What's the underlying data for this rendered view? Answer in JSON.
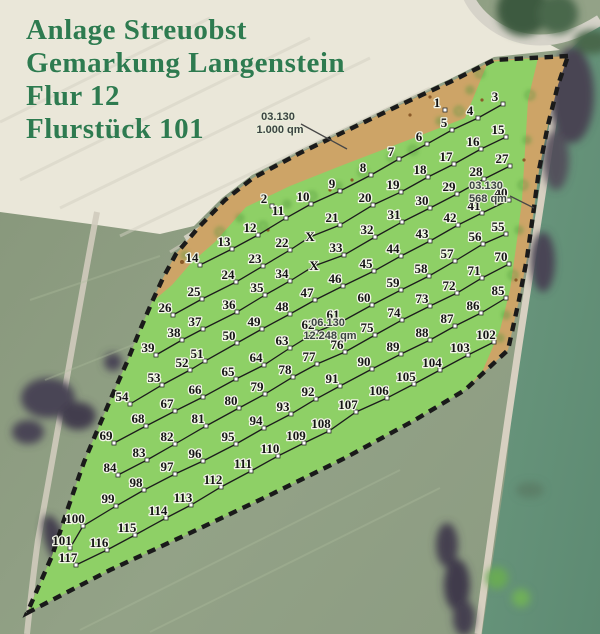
{
  "title": {
    "lines": [
      "Anlage Streuobst",
      "Gemarkung Langenstein",
      "Flur 12",
      "Flurstück 101"
    ]
  },
  "area_labels": [
    {
      "name": "north-strip-label",
      "code": "03.130",
      "area": "1.000 qm",
      "x": 278,
      "y": 120,
      "leader": [
        301,
        124,
        347,
        149
      ]
    },
    {
      "name": "east-strip-label",
      "code": "03.130",
      "area": "568 qm",
      "x": 486,
      "y": 189,
      "leader": [
        510,
        196,
        534,
        208
      ]
    },
    {
      "name": "main-parcel-label",
      "code": "06.130",
      "area": "12.248 qm",
      "x": 328,
      "y": 326,
      "leader": null
    }
  ],
  "planting": {
    "rows": [
      {
        "connected": false,
        "points": [
          [
            "1",
            445,
            110
          ],
          [
            "2",
            272,
            206
          ]
        ]
      },
      {
        "connected": true,
        "points": [
          [
            "3",
            503,
            104
          ],
          [
            "4",
            478,
            118
          ],
          [
            "5",
            452,
            130
          ],
          [
            "6",
            427,
            144
          ],
          [
            "7",
            399,
            159
          ],
          [
            "8",
            371,
            175
          ],
          [
            "9",
            340,
            191
          ],
          [
            "10",
            311,
            204
          ],
          [
            "11",
            286,
            218
          ],
          [
            "12",
            258,
            235
          ],
          [
            "13",
            232,
            249
          ],
          [
            "14",
            200,
            265
          ]
        ]
      },
      {
        "connected": true,
        "points": [
          [
            "15",
            506,
            137
          ],
          [
            "16",
            481,
            149
          ],
          [
            "17",
            454,
            164
          ],
          [
            "18",
            428,
            177
          ],
          [
            "19",
            401,
            192
          ],
          [
            "20",
            373,
            205
          ],
          [
            "21",
            340,
            225
          ],
          [
            "X",
            310,
            237,
            "x"
          ],
          [
            "22",
            290,
            250
          ],
          [
            "23",
            263,
            266
          ],
          [
            "24",
            236,
            282
          ],
          [
            "25",
            202,
            299
          ],
          [
            "26",
            173,
            315
          ]
        ]
      },
      {
        "connected": true,
        "points": [
          [
            "27",
            510,
            166
          ],
          [
            "28",
            484,
            179
          ],
          [
            "29",
            457,
            194
          ],
          [
            "30",
            430,
            208
          ],
          [
            "31",
            402,
            222
          ],
          [
            "32",
            375,
            237
          ],
          [
            "33",
            344,
            255
          ],
          [
            "X",
            314,
            266,
            "x"
          ],
          [
            "34",
            290,
            281
          ],
          [
            "35",
            265,
            295
          ],
          [
            "36",
            237,
            312
          ],
          [
            "37",
            203,
            329
          ],
          [
            "38",
            182,
            340
          ],
          [
            "39",
            156,
            355
          ]
        ]
      },
      {
        "connected": true,
        "points": [
          [
            "40",
            509,
            200
          ],
          [
            "41",
            482,
            213
          ],
          [
            "42",
            458,
            225
          ],
          [
            "43",
            430,
            241
          ],
          [
            "44",
            401,
            256
          ],
          [
            "45",
            374,
            271
          ],
          [
            "46",
            343,
            286
          ],
          [
            "47",
            315,
            300
          ],
          [
            "48",
            290,
            314
          ],
          [
            "49",
            262,
            329
          ],
          [
            "50",
            237,
            343
          ],
          [
            "51",
            205,
            361
          ],
          [
            "52",
            190,
            370
          ],
          [
            "53",
            162,
            385
          ],
          [
            "54",
            130,
            404
          ]
        ]
      },
      {
        "connected": true,
        "points": [
          [
            "55",
            506,
            234
          ],
          [
            "56",
            483,
            244
          ],
          [
            "57",
            455,
            261
          ],
          [
            "58",
            429,
            276
          ],
          [
            "59",
            401,
            290
          ],
          [
            "60",
            372,
            305
          ],
          [
            "61",
            341,
            322
          ],
          [
            "62",
            316,
            332
          ],
          [
            "63",
            290,
            348
          ],
          [
            "64",
            264,
            365
          ],
          [
            "65",
            236,
            379
          ],
          [
            "66",
            203,
            397
          ],
          [
            "67",
            175,
            411
          ],
          [
            "68",
            146,
            426
          ],
          [
            "69",
            114,
            443
          ]
        ]
      },
      {
        "connected": true,
        "points": [
          [
            "70",
            509,
            264
          ],
          [
            "71",
            482,
            278
          ],
          [
            "72",
            457,
            293
          ],
          [
            "73",
            430,
            306
          ],
          [
            "74",
            402,
            320
          ],
          [
            "75",
            375,
            335
          ],
          [
            "76",
            345,
            352
          ],
          [
            "77",
            317,
            364
          ],
          [
            "78",
            293,
            377
          ],
          [
            "79",
            265,
            394
          ],
          [
            "80",
            239,
            408
          ],
          [
            "81",
            206,
            426
          ],
          [
            "82",
            175,
            444
          ],
          [
            "83",
            147,
            460
          ],
          [
            "84",
            118,
            475
          ]
        ]
      },
      {
        "connected": true,
        "points": [
          [
            "85",
            506,
            298
          ],
          [
            "86",
            481,
            313
          ],
          [
            "87",
            455,
            326
          ],
          [
            "88",
            430,
            340
          ],
          [
            "89",
            401,
            354
          ],
          [
            "90",
            372,
            369
          ],
          [
            "91",
            340,
            386
          ],
          [
            "92",
            316,
            399
          ],
          [
            "93",
            291,
            414
          ],
          [
            "94",
            264,
            428
          ],
          [
            "95",
            236,
            444
          ],
          [
            "96",
            203,
            461
          ],
          [
            "97",
            175,
            474
          ],
          [
            "98",
            144,
            490
          ],
          [
            "99",
            116,
            506
          ],
          [
            "100",
            83,
            526
          ],
          [
            "101",
            70,
            548
          ]
        ]
      },
      {
        "connected": true,
        "points": [
          [
            "102",
            494,
            342
          ],
          [
            "103",
            468,
            355
          ],
          [
            "104",
            440,
            370
          ],
          [
            "105",
            414,
            384
          ],
          [
            "106",
            387,
            398
          ],
          [
            "107",
            356,
            412
          ],
          [
            "108",
            329,
            431
          ],
          [
            "109",
            304,
            443
          ],
          [
            "110",
            278,
            456
          ],
          [
            "111",
            251,
            471
          ],
          [
            "112",
            221,
            487
          ],
          [
            "113",
            191,
            505
          ],
          [
            "114",
            166,
            518
          ],
          [
            "115",
            135,
            535
          ],
          [
            "116",
            107,
            550
          ],
          [
            "117",
            76,
            565
          ]
        ]
      }
    ]
  },
  "colors": {
    "parcel_green": "#8ed066",
    "strip_tan": "#cda467",
    "boundary": "#1a1a1a",
    "title_green": "#2e7b50",
    "row_line": "#1c1c1c",
    "label_text": "#3b4442"
  }
}
